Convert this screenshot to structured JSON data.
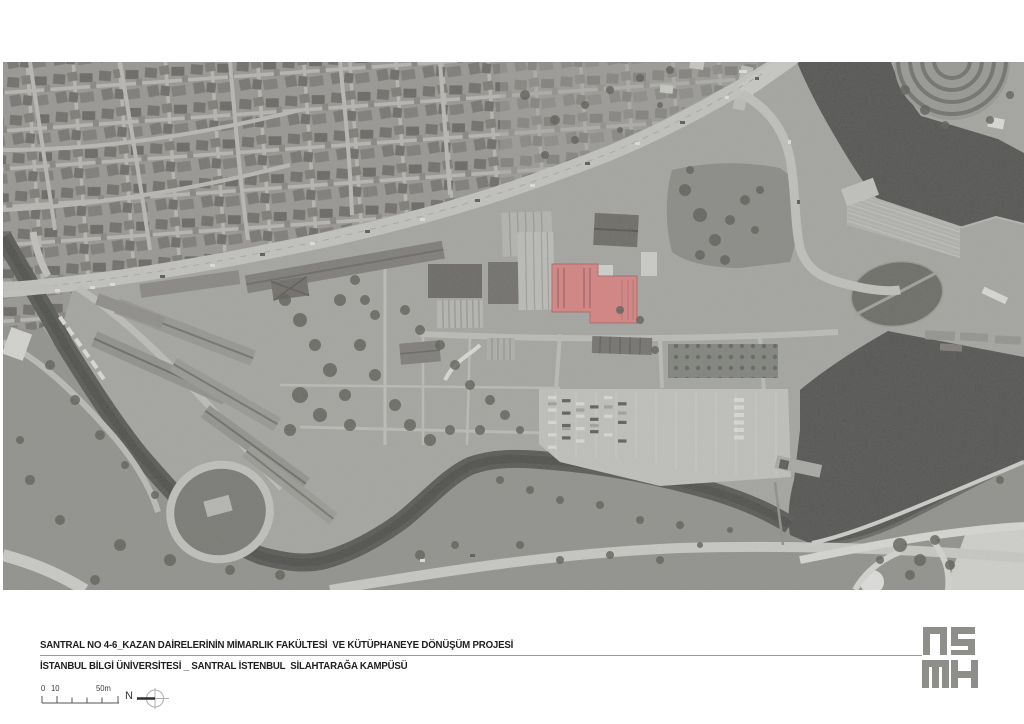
{
  "captions": {
    "line1": "SANTRAL NO 4-6_KAZAN DAİRELERİNİN MİMARLIK FAKÜLTESİ  VE KÜTÜPHANEYE DÖNÜŞÜM PROJESİ",
    "line2": "İSTANBUL BİLGİ ÜNİVERSİTESİ _ SANTRAL İSTENBUL  SİLAHTARAĞA KAMPÜSÜ"
  },
  "scale_bar": {
    "labels": [
      "0",
      "10",
      "50m"
    ]
  },
  "north_arrow": {
    "label": "N"
  },
  "logo": {
    "text": "NSMH",
    "color": "#8e8e8a"
  },
  "aerial_photo": {
    "description": "Black-and-white aerial photograph of the santralistanbul Silahtarağa campus with boiler houses no 4-6 highlighted in red",
    "highlight_color": "#ec6f6f",
    "water_color": "#343634",
    "land_color": "#a2a29e",
    "road_color": "#cacac6"
  }
}
